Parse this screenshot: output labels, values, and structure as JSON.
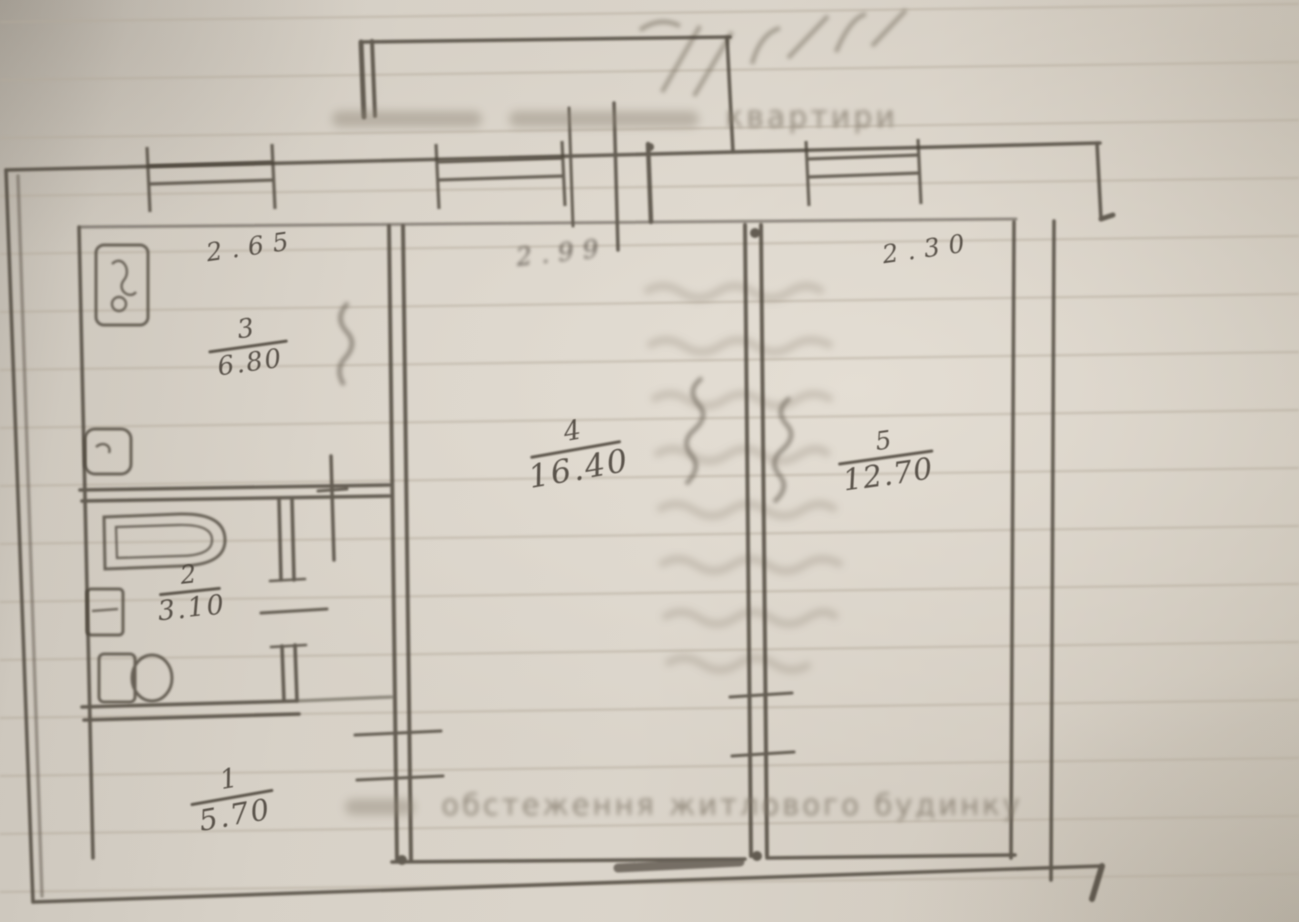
{
  "meta": {
    "description": "Photograph of a hand-drawn pencil apartment floor plan on faded lined paper",
    "language": "Ukrainian"
  },
  "captions": {
    "top_tail": "квартири",
    "bottom": "обстеження житлового будинку"
  },
  "rooms": [
    {
      "number": "1",
      "area": "5.70"
    },
    {
      "number": "2",
      "area": "3.10"
    },
    {
      "number": "3",
      "area": "6.80"
    },
    {
      "number": "4",
      "area": "16.40"
    },
    {
      "number": "5",
      "area": "12.70"
    }
  ],
  "dims": {
    "left": "2.65",
    "center": "2.99",
    "right": "2.30"
  },
  "colors": {
    "paper": "#d7d1c7",
    "pencil": "#4a4339",
    "ghost_ink": "#948a7c",
    "ruled_line": "#b4aa9b"
  },
  "decorations": [
    "ruled-paper-lines",
    "ghost-bleedthrough-writing-rows",
    "top-right-pencil-scribble",
    "vertical-pencil-scribbles-near-walls",
    "illegible-faded-caption-words"
  ]
}
